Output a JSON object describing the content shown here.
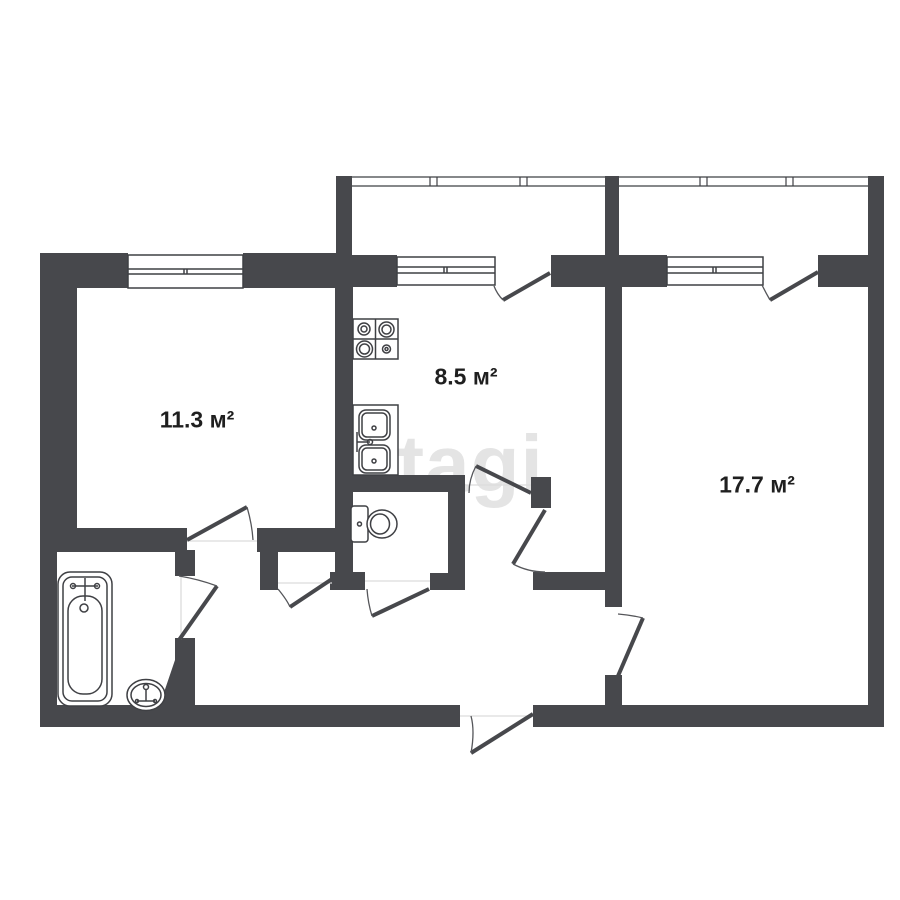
{
  "watermark": {
    "text": "etagi"
  },
  "rooms": [
    {
      "name": "living-room",
      "area_label": "11.3 м²"
    },
    {
      "name": "kitchen",
      "area_label": "8.5 м²"
    },
    {
      "name": "bedroom",
      "area_label": "17.7 м²"
    }
  ],
  "fixtures": {
    "bathtub": "bathtub-icon",
    "washbasin": "washbasin-icon",
    "toilet": "toilet-icon",
    "stove": "stove-icon",
    "kitchen_sink": "kitchen-sink-icon"
  },
  "colors": {
    "wall": "#47484c",
    "line": "#3f4044",
    "arc": "#55565a",
    "background": "#ffffff",
    "watermark": "#e4e4e4",
    "label": "#1f1f1f",
    "threshold": "#dcdcdc"
  }
}
